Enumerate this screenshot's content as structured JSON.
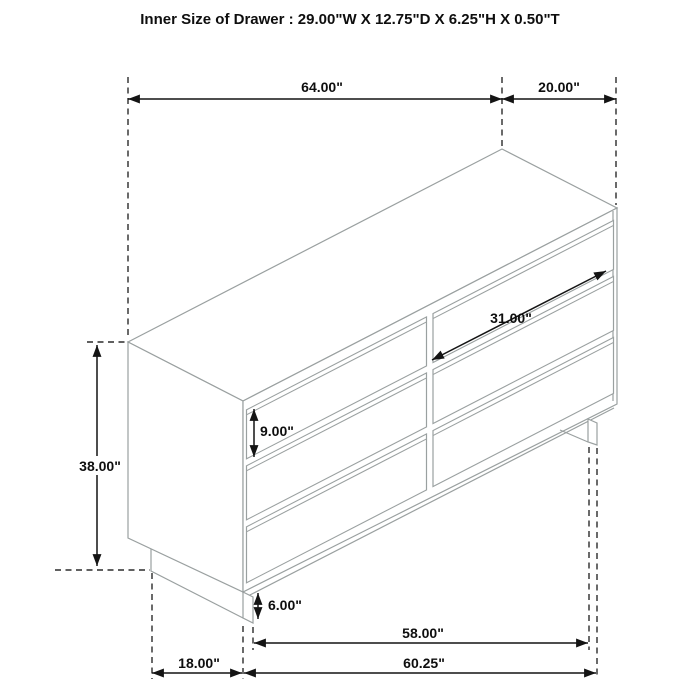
{
  "title": "Inner Size of Drawer : 29.00\"W X 12.75\"D X 6.25\"H X 0.50\"T",
  "dimensions": {
    "overall_width": "64.00\"",
    "depth": "20.00\"",
    "drawer_width": "31.00\"",
    "drawer_front_height": "9.00\"",
    "overall_height": "38.00\"",
    "base_height": "6.00\"",
    "base_inner_width": "58.00\"",
    "base_depth": "18.00\"",
    "base_width": "60.25\""
  }
}
